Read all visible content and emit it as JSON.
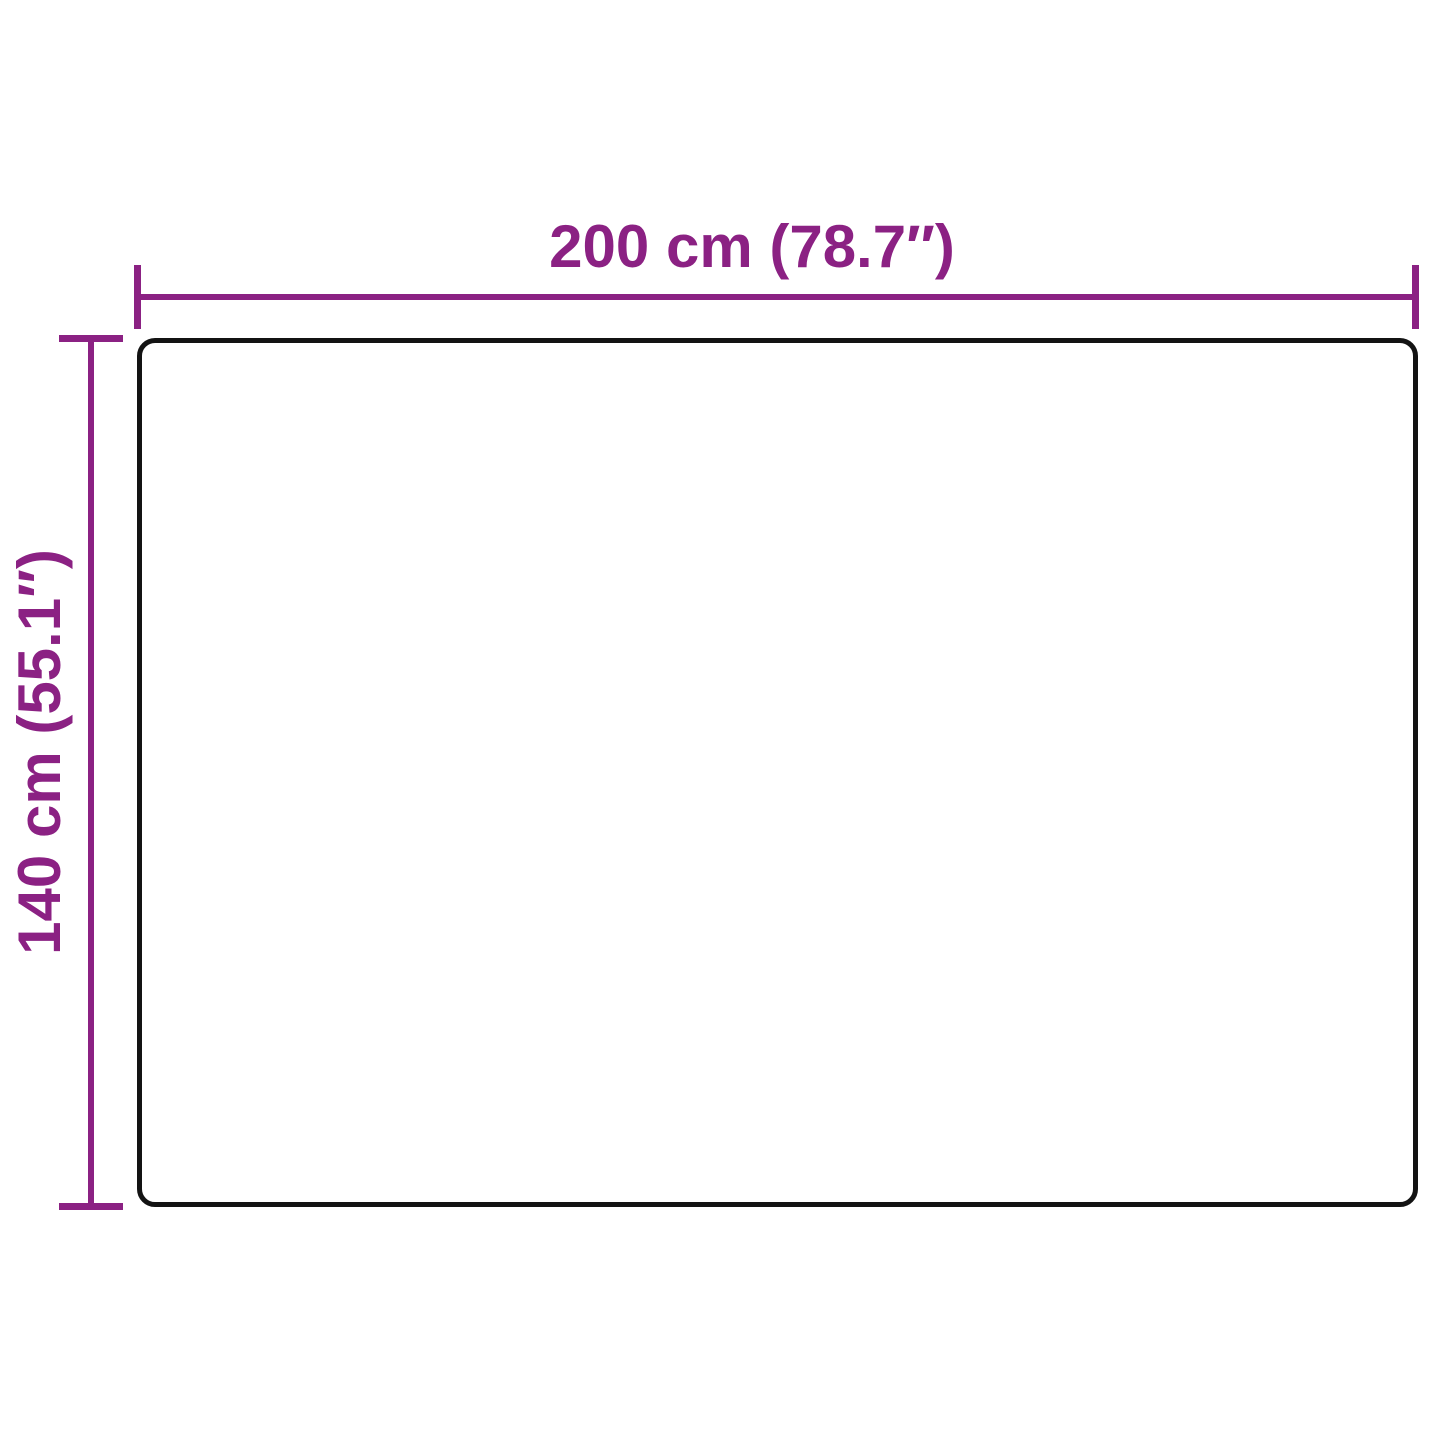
{
  "diagram": {
    "type": "product-dimension-diagram",
    "width_dimension": {
      "label": "200 cm (78.7″)",
      "value_cm": 200,
      "value_inches": 78.7
    },
    "height_dimension": {
      "label": "140 cm (55.1″)",
      "value_cm": 140,
      "value_inches": 55.1
    }
  },
  "colors": {
    "dimension": "#8b2183",
    "outline": "#131313",
    "background": "#ffffff"
  }
}
